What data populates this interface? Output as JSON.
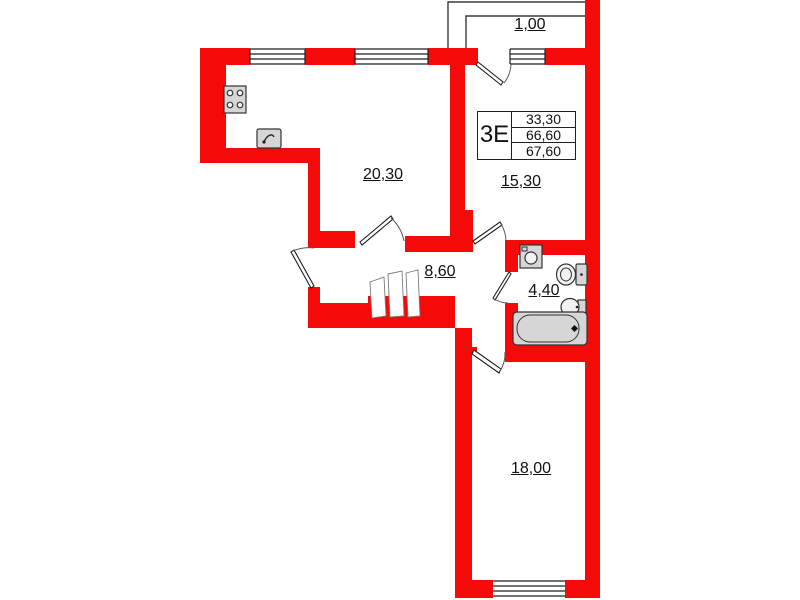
{
  "colors": {
    "wall": "#f50a0a",
    "line": "#1f1f1f",
    "fixture_fill": "#d6d6d6",
    "background": "#ffffff"
  },
  "plan": {
    "summary": {
      "type": "3Е",
      "rows": [
        "33,30",
        "66,60",
        "67,60"
      ]
    },
    "room_areas": {
      "balcony": "1,00",
      "kitchen_living": "20,30",
      "bedroom_top": "15,30",
      "hallway": "8,60",
      "bathroom": "4,40",
      "bedroom_bottom": "18,00"
    },
    "fixture_icons": [
      "stove-icon",
      "kitchen-sink-icon",
      "washing-machine-icon",
      "toilet-icon",
      "washbasin-icon",
      "bathtub-icon",
      "wardrobe-icon"
    ]
  }
}
